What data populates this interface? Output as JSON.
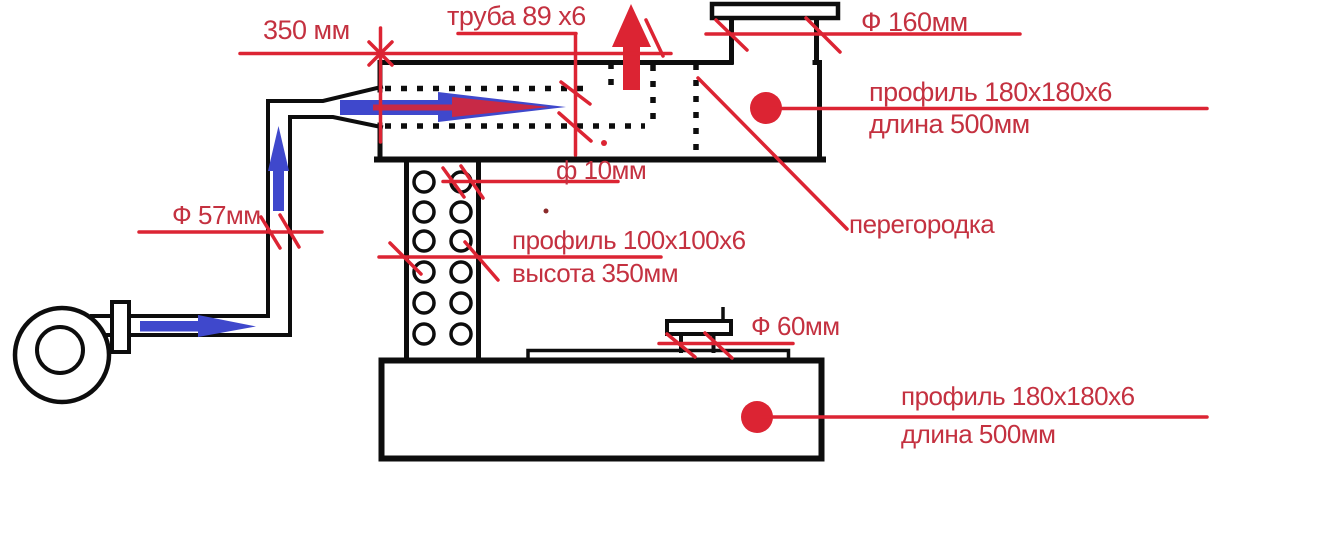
{
  "colors": {
    "line_red": "#dc2433",
    "text_red": "#c43140",
    "blue": "#3f48cc",
    "black": "#0d0d0d",
    "background": "#ffffff"
  },
  "annotations": {
    "dim_350": "350 мм",
    "pipe_top": "труба 89 х6",
    "dia_160": "Ф 160мм",
    "profile_top": {
      "line1": "профиль 180х180х6",
      "line2": "длина 500мм"
    },
    "partition": "перегородка",
    "dia_10": "ф 10мм",
    "profile_column": {
      "line1": "профиль 100х100х6",
      "line2": "высота 350мм"
    },
    "dia_57": "Ф 57мм",
    "dia_60": "Ф 60мм",
    "profile_bottom": {
      "line1": "профиль 180х180х6",
      "line2": "длина 500мм"
    }
  }
}
